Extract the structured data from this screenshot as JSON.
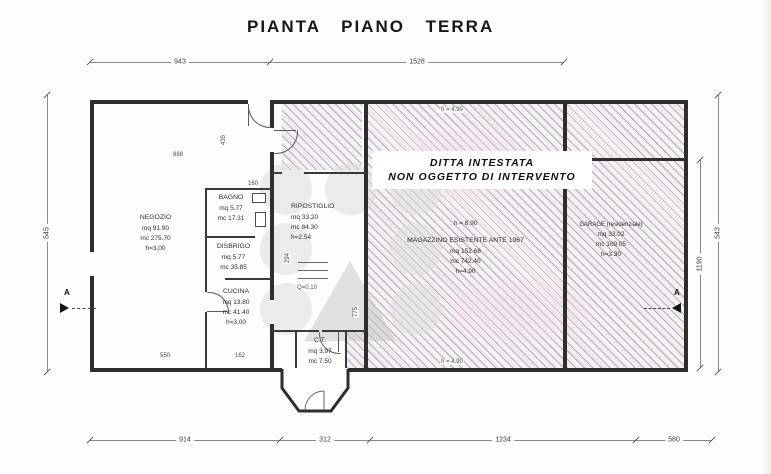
{
  "title": "PIANTA PIANO TERRA",
  "banner": {
    "line1": "DITTA INTESTATA",
    "line2": "NON OGGETTO DI INTERVENTO"
  },
  "rooms": {
    "negozio": {
      "name": "NEGOZIO",
      "area": "mq 91.90",
      "volume": "mc 275.70",
      "height": "h=3.00"
    },
    "bagno": {
      "name": "BAGNO",
      "area": "mq 5.77",
      "volume": "mc 17.31"
    },
    "disbrigo": {
      "name": "DISBRIGO",
      "area": "mq 5.77",
      "volume": "mc 35.85"
    },
    "cucina": {
      "name": "CUCINA",
      "area": "mq 13.80",
      "volume": "mc 41.40",
      "height": "h=3.00"
    },
    "ripostiglio": {
      "name": "RIPOSTIGLIO",
      "area": "mq 33.20",
      "volume": "mc 84.30",
      "height": "h=2.54"
    },
    "magazzino": {
      "ridge_height": "h = 8.90",
      "name": "MAGAZZINO ESISTENTE ANTE 1967",
      "area": "mq 152.68",
      "volume": "mc 742.40",
      "height": "h=4.90"
    },
    "garage": {
      "name": "GARAGE (residenziale)",
      "area": "mq 33.02",
      "volume": "mc 109.05",
      "height": "h=3.30"
    },
    "ct": {
      "name": "C.T.",
      "area": "mq 3.97",
      "volume": "mc 7.50"
    }
  },
  "dimensions": {
    "top": [
      "943",
      "1528"
    ],
    "bottom": [
      "914",
      "312",
      "1234",
      "580"
    ],
    "left": [
      "545"
    ],
    "right_inner": "1190",
    "right_outer": "543",
    "internal": {
      "d888": "888",
      "d435": "435",
      "d160": "160",
      "d294": "294",
      "d550": "550",
      "d162": "162",
      "d775": "775",
      "q": "Q=0.10",
      "h_top": "h = 4.90",
      "h_bottom": "h = 4.90"
    }
  },
  "section_marker": {
    "label": "A"
  }
}
